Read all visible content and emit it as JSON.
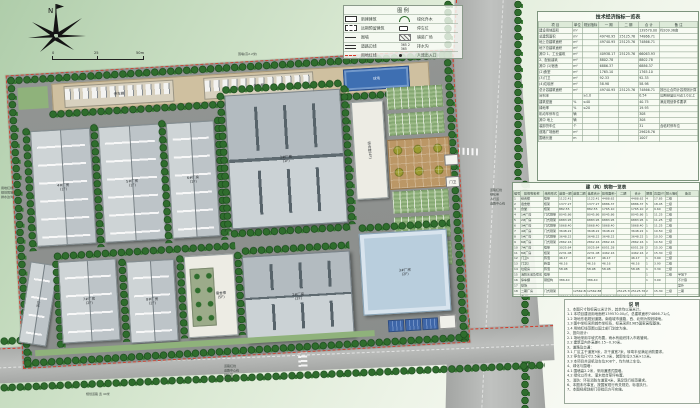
{
  "meta": {
    "sheet_title": "厂区总平面图"
  },
  "colors": {
    "boundary_red": "#d43826",
    "tree_green": "#2f6d2d",
    "ground_gray": "#8e918f",
    "roof_gray": "#c6ccce",
    "blue_roof": "#b9cedd",
    "court_blue": "#3e6fb2",
    "plaza_tan": "#bb9766",
    "table_bg": "#f6f9f2"
  },
  "compass": {
    "north_label": "N"
  },
  "scalebar": {
    "labels": [
      "0",
      "25",
      "50m"
    ]
  },
  "legend": {
    "title": "图 例",
    "items": [
      {
        "label": "新建建筑"
      },
      {
        "label": "远期预留建筑"
      },
      {
        "label": "围墙"
      },
      {
        "label": "道路边线"
      },
      {
        "label": "用地红线"
      },
      {
        "label": "绿化乔木"
      },
      {
        "label": "停车位"
      },
      {
        "label": "铺装广场"
      },
      {
        "label": "排水沟"
      },
      {
        "label": "人流出入口"
      }
    ]
  },
  "plan": {
    "buildings": {
      "f1": {
        "label": "1#厂房",
        "sub": "(1F)"
      },
      "f2": {
        "label": "2#厂房",
        "sub": "(2F)"
      },
      "f3": {
        "label": "3#厂房",
        "sub": "(2F)"
      },
      "f4": {
        "label": "4#厂房",
        "sub": "(1F)"
      },
      "f5": {
        "label": "5#厂房",
        "sub": "(1F)"
      },
      "f6": {
        "label": "6#厂房",
        "sub": "(1F)"
      },
      "f7": {
        "label": "7#厂房",
        "sub": "(2F)"
      },
      "f8": {
        "label": "8#厂房",
        "sub": "(2F)"
      },
      "office": {
        "label": "综合楼",
        "sub": "(4F)"
      },
      "dorm": {
        "label": "宿舍楼",
        "sub": "(5F)"
      },
      "warehouse": {
        "label": "仓库",
        "sub": "(1F)"
      },
      "court": {
        "label": "球场"
      },
      "carport1": {
        "label": "停车棚"
      },
      "carport2": {
        "label": "停车棚"
      },
      "gate": {
        "label": "门卫"
      }
    },
    "annotations": {
      "north_wall": "围墙(高2.2米)",
      "west_stack": [
        "用地红线",
        "规划围墙",
        "排水边沟"
      ],
      "east_stack": [
        "道路红线",
        "绿化带",
        "人行道",
        "道路中心线"
      ],
      "south_stack": [
        "道路红线",
        "道路中心线",
        "绿化带",
        "人行道"
      ],
      "south_road_name": "纬  一  路",
      "south_road_note": "规划道路 宽 40米"
    }
  },
  "tables": {
    "indicators": {
      "title": "技术经济指标一览表",
      "header": [
        "项  目",
        "单位",
        "规划指标",
        "一 期",
        "二 期",
        "合 计",
        "备  注"
      ],
      "rows": [
        [
          "建设用地面积",
          "m²",
          "",
          "",
          "",
          "139570.00",
          "约209.36亩"
        ],
        [
          "总建筑面积",
          "m²",
          "",
          "49740.95",
          "25125.76",
          "74866.71",
          ""
        ],
        [
          "地上总建筑面积",
          "m²",
          "",
          "49740.95",
          "25125.76",
          "74866.71",
          ""
        ],
        [
          "地下总建筑面积",
          "m²",
          "",
          "",
          "",
          "",
          ""
        ],
        [
          "其中 1、工业建筑",
          "m²",
          "",
          "40938.17",
          "25125.76",
          "66063.93",
          ""
        ],
        [
          "2、配套建筑",
          "m²",
          "",
          "8802.78",
          "",
          "8802.78",
          ""
        ],
        [
          "其中 (1)宿舍",
          "m²",
          "",
          "6886.37",
          "",
          "6886.37",
          ""
        ],
        [
          "(2)食堂",
          "m²",
          "",
          "1765.10",
          "",
          "1765.10",
          ""
        ],
        [
          "(3)门卫",
          "m²",
          "",
          "92.33",
          "",
          "92.33",
          ""
        ],
        [
          "(4)垃圾房",
          "m²",
          "",
          "58.98",
          "",
          "58.98",
          ""
        ],
        [
          "总计容建筑面积",
          "m²",
          "",
          "49740.95",
          "25125.76",
          "74866.71",
          "按出让合同计容规则计算"
        ],
        [
          "容积率",
          "",
          "≥1.0",
          "",
          "",
          "0.54",
          "远期预留后可达1.0以上"
        ],
        [
          "建筑密度",
          "%",
          "≤40",
          "",
          "",
          "40.75",
          "满足规划条件要求"
        ],
        [
          "绿地率",
          "%",
          "≤20",
          "",
          "",
          "19.93",
          ""
        ],
        [
          "机动车停车位",
          "辆",
          "",
          "",
          "",
          "308",
          ""
        ],
        [
          "其中 地上",
          "辆",
          "",
          "",
          "",
          "308",
          ""
        ],
        [
          "装卸货车位",
          "个",
          "",
          "",
          "",
          "31",
          "含临时停车位"
        ],
        [
          "道路广场面积",
          "m²",
          "",
          "",
          "",
          "29628.76",
          ""
        ],
        [
          "围墙长度",
          "m",
          "",
          "",
          "",
          "1007",
          ""
        ]
      ]
    },
    "buildings_list": {
      "title": "建（构）筑物一览表",
      "header": [
        "编号",
        "建筑物名称",
        "结构形式",
        "基底一期",
        "基底二期",
        "基底合计",
        "建筑面积一期",
        "二期",
        "合计",
        "层数",
        "高度(m)",
        "耐火等级",
        "备注"
      ],
      "rows": [
        [
          "1",
          "综合楼",
          "框架",
          "1122.41",
          "",
          "1122.41",
          "4488.62",
          "",
          "4488.62",
          "4",
          "17.85",
          "二级",
          ""
        ],
        [
          "2",
          "宿舍楼",
          "框架",
          "1377.27",
          "",
          "1377.27",
          "6886.37",
          "",
          "6886.37",
          "5",
          "18.45",
          "二级",
          ""
        ],
        [
          "3",
          "食堂",
          "框架",
          "882.55",
          "",
          "882.55",
          "1765.10",
          "",
          "1765.10",
          "2",
          "9.60",
          "二级",
          ""
        ],
        [
          "4",
          "1#厂房",
          "门式刚架",
          "8045.86",
          "",
          "8045.86",
          "8045.86",
          "",
          "8045.86",
          "1",
          "11.25",
          "二级",
          ""
        ],
        [
          "5",
          "2#厂房",
          "门式刚架",
          "6883.95",
          "",
          "6883.95",
          "6883.95",
          "",
          "6883.95",
          "1",
          "11.25",
          "二级",
          ""
        ],
        [
          "6",
          "3#厂房",
          "门式刚架",
          "5868.40",
          "",
          "5868.40",
          "5868.40",
          "",
          "5868.40",
          "1",
          "11.25",
          "二级",
          ""
        ],
        [
          "7",
          "4#厂房",
          "门式刚架",
          "3648.22",
          "",
          "3648.22",
          "3648.22",
          "",
          "3648.22",
          "1",
          "10.50",
          "二级",
          ""
        ],
        [
          "8",
          "5#厂房",
          "门式刚架",
          "3648.22",
          "",
          "3648.22",
          "3648.22",
          "",
          "3648.22",
          "1",
          "10.50",
          "二级",
          ""
        ],
        [
          "9",
          "6#厂房",
          "门式刚架",
          "2862.16",
          "",
          "2862.16",
          "2862.16",
          "",
          "2862.16",
          "1",
          "10.50",
          "二级",
          ""
        ],
        [
          "10",
          "7#厂房",
          "框架",
          "3025.64",
          "",
          "3025.64",
          "6051.28",
          "",
          "6051.28",
          "2",
          "15.30",
          "二级",
          ""
        ],
        [
          "11",
          "8#厂房",
          "框架",
          "2231.08",
          "",
          "2231.08",
          "4462.16",
          "",
          "4462.16",
          "2",
          "15.30",
          "二级",
          ""
        ],
        [
          "12",
          "门卫1",
          "砖混",
          "46.17",
          "",
          "46.17",
          "46.17",
          "",
          "46.17",
          "1",
          "3.90",
          "二级",
          ""
        ],
        [
          "13",
          "门卫2",
          "砖混",
          "46.16",
          "",
          "46.16",
          "46.16",
          "",
          "46.16",
          "1",
          "3.90",
          "二级",
          ""
        ],
        [
          "14",
          "垃圾房",
          "砖混",
          "58.98",
          "",
          "58.98",
          "58.98",
          "",
          "58.98",
          "1",
          "3.30",
          "二级",
          ""
        ],
        [
          "15",
          "消防水池及泵房",
          "框架",
          "",
          "",
          "",
          "",
          "",
          "",
          "1",
          "",
          "二级",
          "半地下"
        ],
        [
          "16",
          "停车棚",
          "钢结构",
          "386.40",
          "",
          "386.40",
          "",
          "",
          "",
          "1",
          "3.00",
          "",
          "不计容"
        ],
        [
          "17",
          "球场",
          "",
          "",
          "",
          "",
          "",
          "",
          "",
          "",
          "",
          "",
          "室外"
        ],
        [
          "18",
          "二期厂房",
          "门式刚架",
          "",
          "12562.88",
          "12562.88",
          "",
          "25125.76",
          "25125.76",
          "2",
          "15.30",
          "二级",
          "二期"
        ],
        [
          "",
          "合  计",
          "",
          "38566.90",
          "12562.88",
          "51129.78",
          "49740.95",
          "25125.76",
          "74866.71",
          "",
          "",
          "",
          ""
        ]
      ]
    }
  },
  "notes": {
    "title": "说  明",
    "lines": [
      "1、本图尺寸除标高以米计外，其余均以毫米计。",
      "  1.1 本项目建设用地面积139570.00㎡，总建筑面积74866.71㎡。",
      "  1.2 场地东临规划道路，南临城市道路，西、北侧为规划绿地。",
      "  1.3 图中坐标采用城市坐标系，标高采用1985国家高程基准。",
      "  1.4 用地红线范围以国土部门划定为准。",
      "2、竖向设计：",
      "  2.1 场地采用平坡式布置，雨水有组织排入市政管网。",
      "  2.2 建筑室内外高差0.15~0.30米。",
      "3、道路及交通：",
      "  3.1 厂区主干道宽9米，次干道宽7米，转弯半径满足消防要求。",
      "  3.2 停车位尺寸2.5米×5.3米，装卸车位3.5米×12米。",
      "  3.3 本项目共设机动车位308个，均为地上车位。",
      "4、绿化与围墙：",
      "  4.1 围墙高2.2米，采用通透式围墙。",
      "  4.2 绿化以乔木、灌木结合草坪布置。",
      "5、消防：环形消防车道宽4米，满足现行规范要求。",
      "6、本图未尽事宜，按国家现行有关规范、标准执行。",
      "7、本图经规划部门审批后方可实施。"
    ]
  }
}
